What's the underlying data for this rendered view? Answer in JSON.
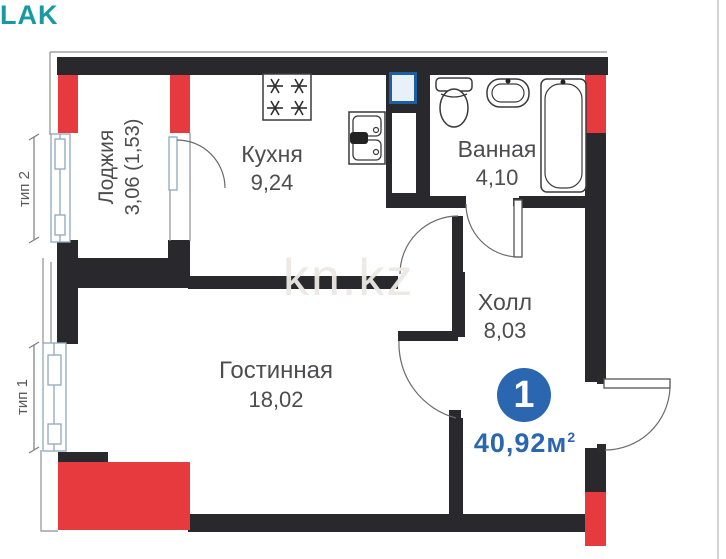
{
  "logo": {
    "text": "LAK"
  },
  "watermark": {
    "text": "kn.kz"
  },
  "type_labels": {
    "type2": "тип 2",
    "type1": "тип 1"
  },
  "rooms": {
    "loggia": {
      "name": "Лоджия",
      "area": "3,06 (1,53)"
    },
    "kitchen": {
      "name": "Кухня",
      "area": "9,24"
    },
    "bathroom": {
      "name": "Ванная",
      "area": "4,10"
    },
    "hall": {
      "name": "Холл",
      "area": "8,03"
    },
    "living": {
      "name": "Гостинная",
      "area": "18,02"
    }
  },
  "summary": {
    "rooms_count": "1",
    "total_area": "40,92м",
    "area_exponent": "2"
  },
  "icons": [
    "stove-icon",
    "kitchen-sink-icon",
    "toilet-icon",
    "washbasin-icon",
    "bathtub-icon",
    "vent-shaft-icon",
    "window-icon",
    "door-arc-icon"
  ],
  "colors": {
    "wall_black": "#29292d",
    "accent_red": "#e63a3e",
    "badge_blue": "#2b66b0",
    "vent_border_blue": "#1d5fa6",
    "logo_teal": "#189aa2",
    "label_gray": "#4d4d4f"
  }
}
